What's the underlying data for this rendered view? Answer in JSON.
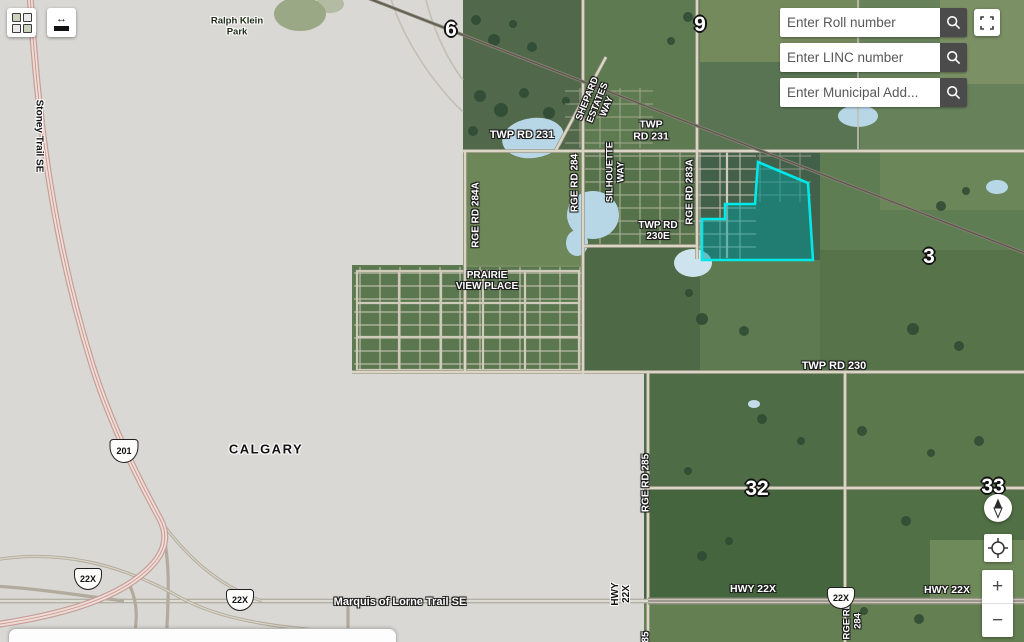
{
  "search": {
    "roll_placeholder": "Enter Roll number",
    "linc_placeholder": "Enter LINC number",
    "municipal_placeholder": "Enter Municipal Add...",
    "button_color": "#4b4b4b"
  },
  "controls": {
    "zoom_in": "+",
    "zoom_out": "−"
  },
  "labels": {
    "park": "Ralph Klein\nPark",
    "stoney_trail": "Stoney Trail SE",
    "calgary": "CALGARY",
    "twp_rd_231_w": "TWP RD 231",
    "twp_rd_231_e": "TWP\nRD 231",
    "shepard_estates_way": "SHEPARD\nESTATES\nWAY",
    "silhouette_way": "SILHOUETTE\nWAY",
    "rge_rd_284": "RGE RD 284",
    "rge_rd_284a": "RGE RD 284A",
    "rge_rd_283a": "RGE RD 283A",
    "twp_rd_230e": "TWP RD\n230E",
    "prairie_view_place": "PRAIRIE\nVIEW PLACE",
    "twp_rd_230": "TWP RD 230",
    "rge_rd_285": "RGE RD 285",
    "rge_rd_285_partial": "85",
    "rge_rd_284_s": "RGE RD\n284",
    "marquis_of_lorne": "Marquis of Lorne Trail SE",
    "hwy_22x_v": "HWY\n22X",
    "hwy_22x": "HWY 22X"
  },
  "sections": {
    "s6": "6",
    "s9": "9",
    "s3": "3",
    "s32": "32",
    "s33": "33"
  },
  "shields": {
    "hwy_201": "201",
    "hwy_22x": "22X"
  },
  "highlight": {
    "stroke": "#00e8e8",
    "fill": "rgba(0,153,153,0.5)"
  }
}
